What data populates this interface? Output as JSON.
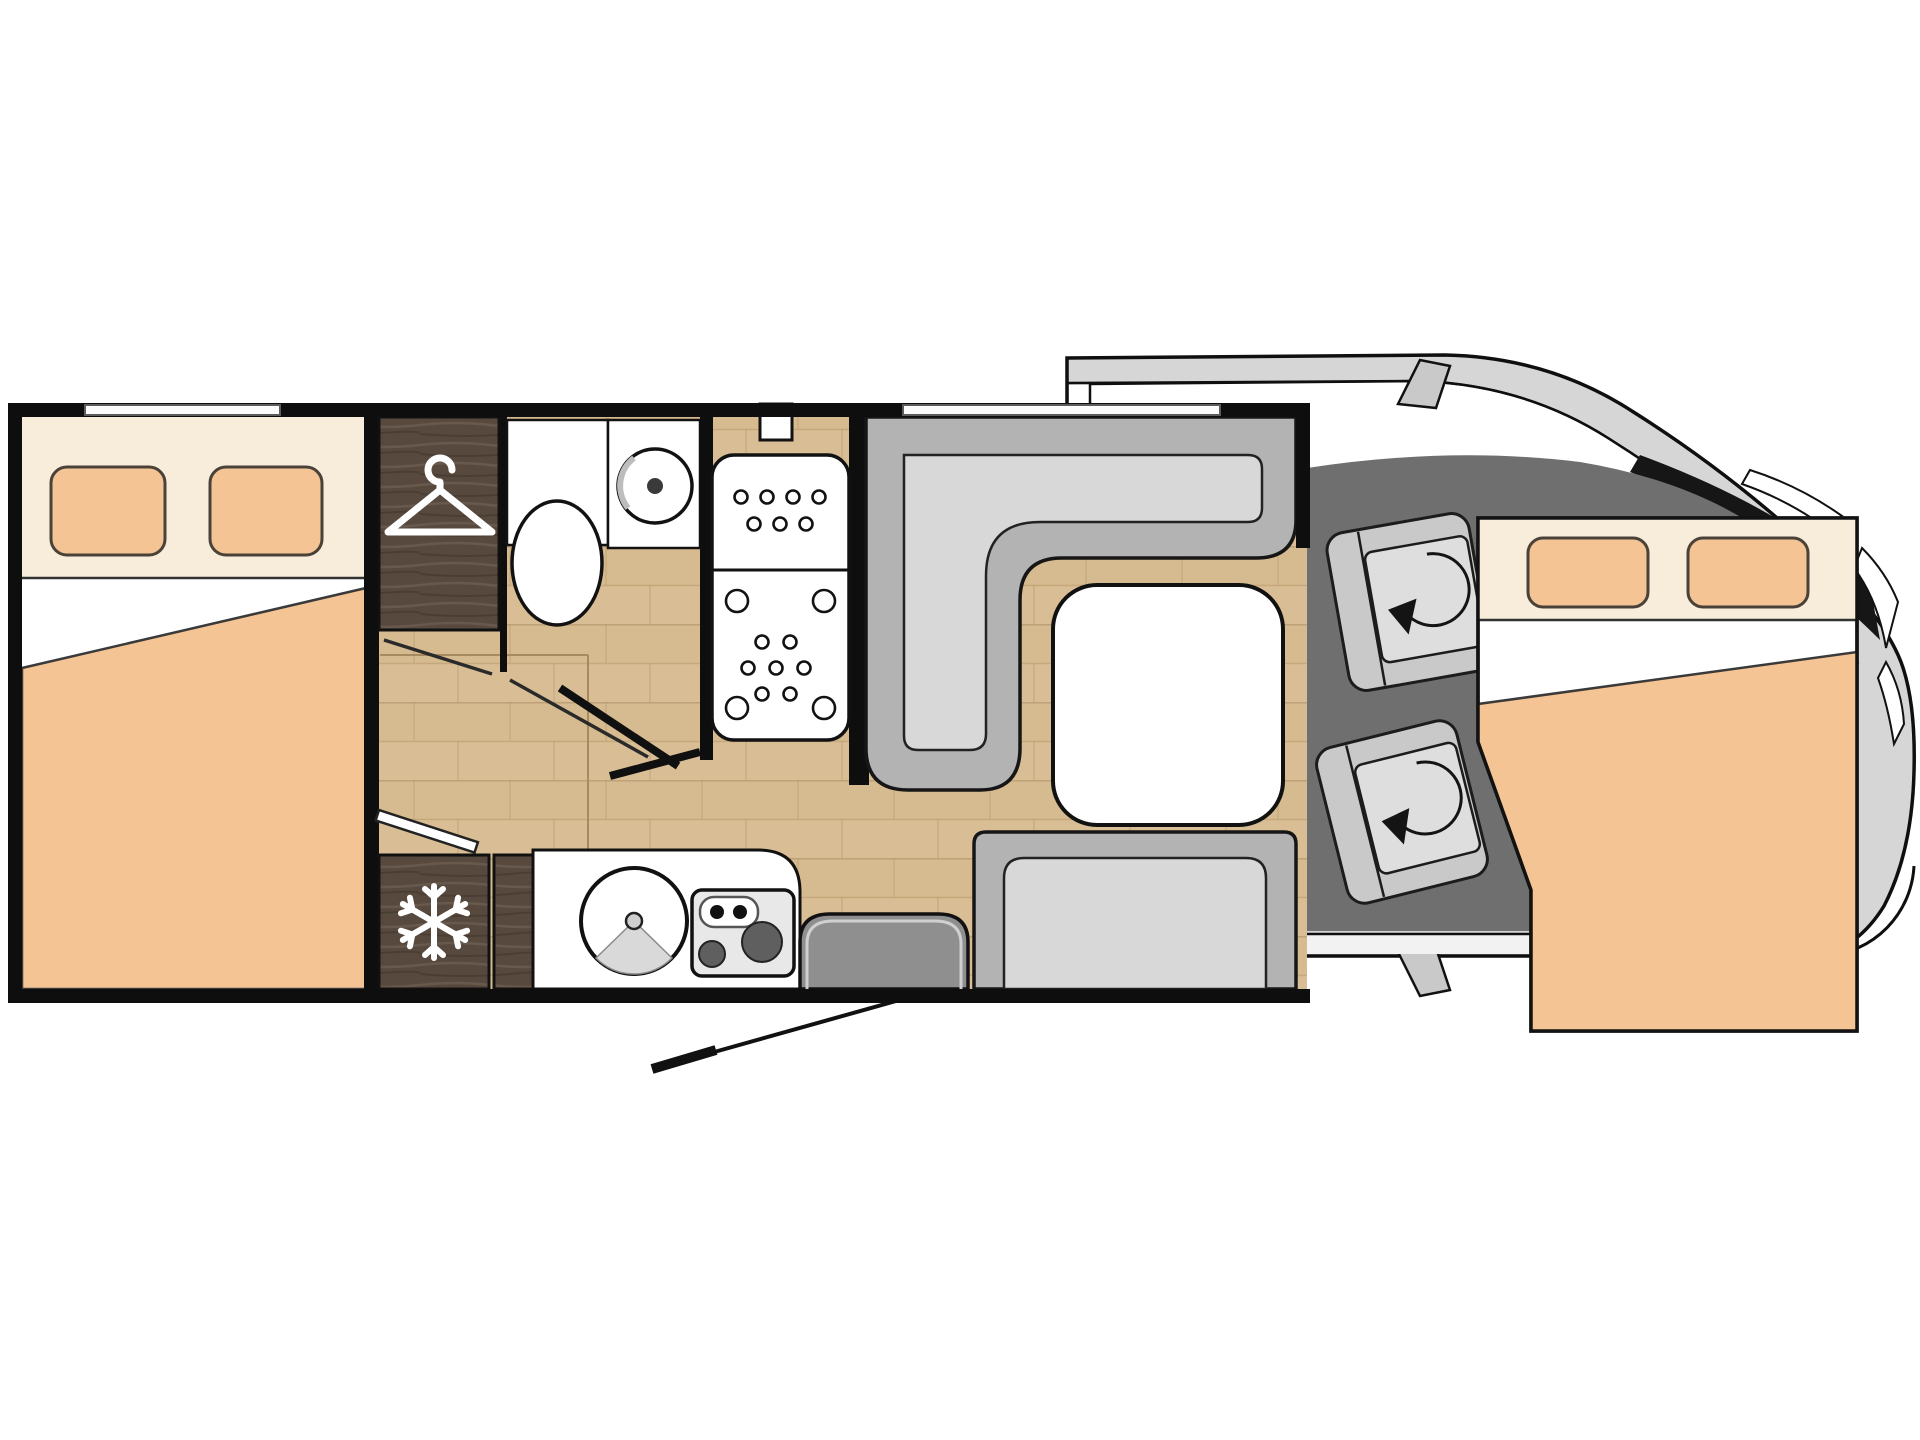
{
  "meta": {
    "document_type": "motorhome-floor-plan",
    "view": "top-down layout drawing, cab facing right",
    "visible_text": ""
  },
  "colors": {
    "wall": "#0e0e0e",
    "white": "#ffffff",
    "cream": "#f8ecdb",
    "peach": "#f5c494",
    "wood": "#d9be95",
    "wood_line": "#b89a6e",
    "dark_wood": "#57493e",
    "seat_back": "#b3b3b3",
    "seat_cushion": "#d8d8d8",
    "cab_floor": "#6f6f6f",
    "body_gray": "#d6d6d6",
    "door_gray": "#8f8f8f"
  },
  "icons": [
    {
      "name": "hanger-icon",
      "meaning": "wardrobe"
    },
    {
      "name": "snowflake-icon",
      "meaning": "refrigerator"
    },
    {
      "name": "swivel-arrow-icon",
      "meaning": "rotating cab seat"
    }
  ],
  "fixtures": [
    {
      "id": "rear-bed",
      "label": "rear double bed with two pillows and duvet"
    },
    {
      "id": "wardrobe",
      "label": "wardrobe with hanger icon"
    },
    {
      "id": "toilet",
      "label": "toilet"
    },
    {
      "id": "washbasin",
      "label": "round washbasin"
    },
    {
      "id": "shower",
      "label": "shower tray with drain dots"
    },
    {
      "id": "dinette-l-seat",
      "label": "L-shaped dinette seat"
    },
    {
      "id": "dinette-table",
      "label": "dinette table"
    },
    {
      "id": "bench-seat",
      "label": "side bench seat"
    },
    {
      "id": "kitchen-counter",
      "label": "kitchen counter"
    },
    {
      "id": "kitchen-sink",
      "label": "round kitchen sink"
    },
    {
      "id": "hob",
      "label": "two-burner hob"
    },
    {
      "id": "fridge",
      "label": "refrigerator with snowflake icon"
    },
    {
      "id": "entry-door",
      "label": "entry door with swing line"
    },
    {
      "id": "cab-seat-driver",
      "label": "driver swivel seat"
    },
    {
      "id": "cab-seat-passenger",
      "label": "passenger swivel seat"
    },
    {
      "id": "drop-down-bed",
      "label": "front drop-down double bed over cab"
    },
    {
      "id": "vehicle-cab",
      "label": "vehicle cab outline with windshield, mirrors and wheel arch"
    }
  ]
}
